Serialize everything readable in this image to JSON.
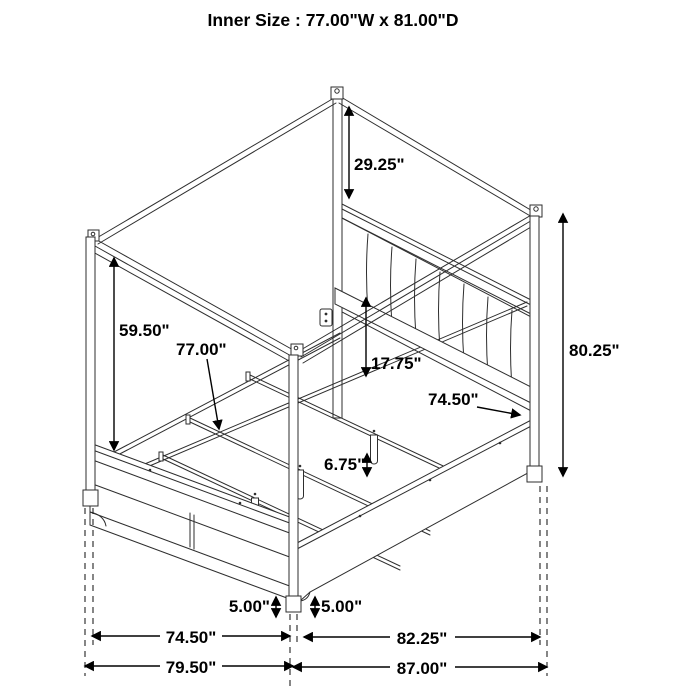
{
  "title": "Inner Size : 77.00\"W x 81.00\"D",
  "diagram_type": "canopy-bed-dimension-line-drawing",
  "colors": {
    "background": "#ffffff",
    "line": "#000000"
  },
  "labels": [
    {
      "id": "canopy-to-headboard-height",
      "text": "29.25\""
    },
    {
      "id": "under-canopy-height",
      "text": "59.50\""
    },
    {
      "id": "inner-width",
      "text": "77.00\""
    },
    {
      "id": "headboard-to-slat-height",
      "text": "17.75\""
    },
    {
      "id": "side-rail-length",
      "text": "74.50\""
    },
    {
      "id": "overall-height",
      "text": "80.25\""
    },
    {
      "id": "slat-leg-height",
      "text": "6.75\""
    },
    {
      "id": "footboard-floor-clearance",
      "text": "5.00\""
    },
    {
      "id": "siderail-floor-clearance",
      "text": "5.00\""
    },
    {
      "id": "footboard-outer-width",
      "text": "74.50\""
    },
    {
      "id": "siderail-outer-span",
      "text": "82.25\""
    },
    {
      "id": "overall-width",
      "text": "79.50\""
    },
    {
      "id": "overall-depth",
      "text": "87.00\""
    }
  ]
}
